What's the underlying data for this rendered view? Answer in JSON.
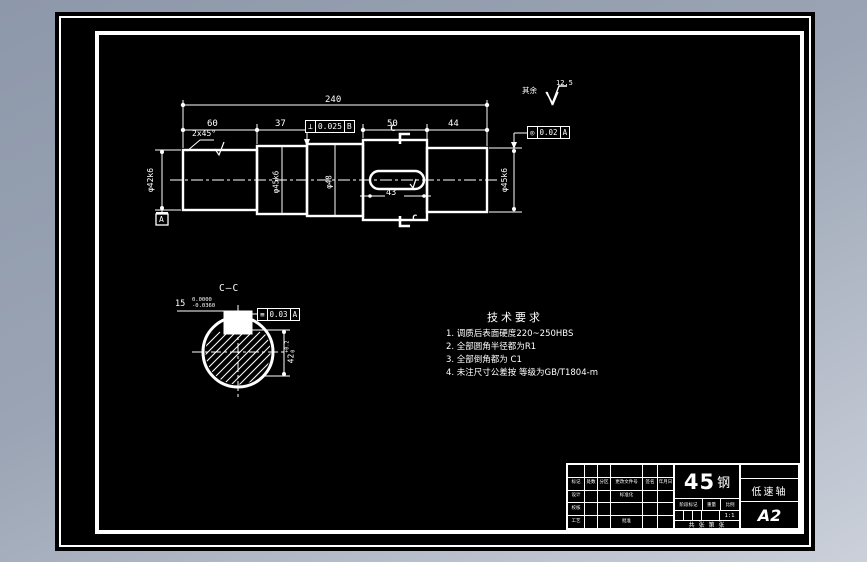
{
  "page": {
    "bg_top": "#8d98aa",
    "bg_bottom": "#cbd0da",
    "sheet_color": "#000000",
    "line_color": "#ffffff"
  },
  "drawing": {
    "surface_note": {
      "prefix": "其余",
      "roughness": "12.5"
    },
    "dims": {
      "overall": "240",
      "seg1": "60",
      "seg2": "37",
      "seg4": "50",
      "seg5": "44",
      "chamfer": "2x45°",
      "keyway_len": "43"
    },
    "labels": {
      "dia_left": "φ42k6",
      "dia_s2": "φ45k6",
      "dia_s3": "φ48",
      "dia_right": "φ45k6",
      "datum": "A",
      "cut_top": "C",
      "cut_bottom": "C"
    },
    "fcf": {
      "perp": {
        "sym": "⊥",
        "val": "0.025",
        "datum": "B"
      },
      "conc": {
        "sym": "◎",
        "val": "0.02",
        "datum": "A"
      },
      "symm": {
        "sym": "≡",
        "val": "0.03",
        "datum": "A"
      }
    },
    "section": {
      "title": "C—C",
      "width": {
        "nom": "15",
        "up": "0.0000",
        "low": "-0.0360"
      },
      "depth": {
        "nom": "42",
        "up": "+0.2",
        "low": "0"
      }
    },
    "tech": {
      "title": "技术要求",
      "items": [
        "1. 调质后表面硬度220~250HBS",
        "2. 全部圆角半径都为R1",
        "3. 全部倒角都为 C1",
        "4. 未注尺寸公差按 等级为GB/T1804-m"
      ]
    }
  },
  "title_block": {
    "material_num": "45",
    "material_suffix": "钢",
    "part_name": "低速轴",
    "sheet_size": "A2",
    "stage_label": "阶段标记",
    "weight_label": "重量",
    "scale_label": "比例",
    "scale_value": "1:1",
    "sheets_note": "共 张 第 张",
    "header_row": [
      "标记",
      "处数",
      "分区",
      "更改文件号",
      "签名",
      "年月日"
    ],
    "sig_rows": [
      [
        "设计",
        "",
        "",
        "标准化",
        "",
        ""
      ],
      [
        "校核",
        "",
        "",
        "",
        "",
        ""
      ],
      [
        "工艺",
        "",
        "",
        "批准",
        "",
        ""
      ]
    ]
  }
}
